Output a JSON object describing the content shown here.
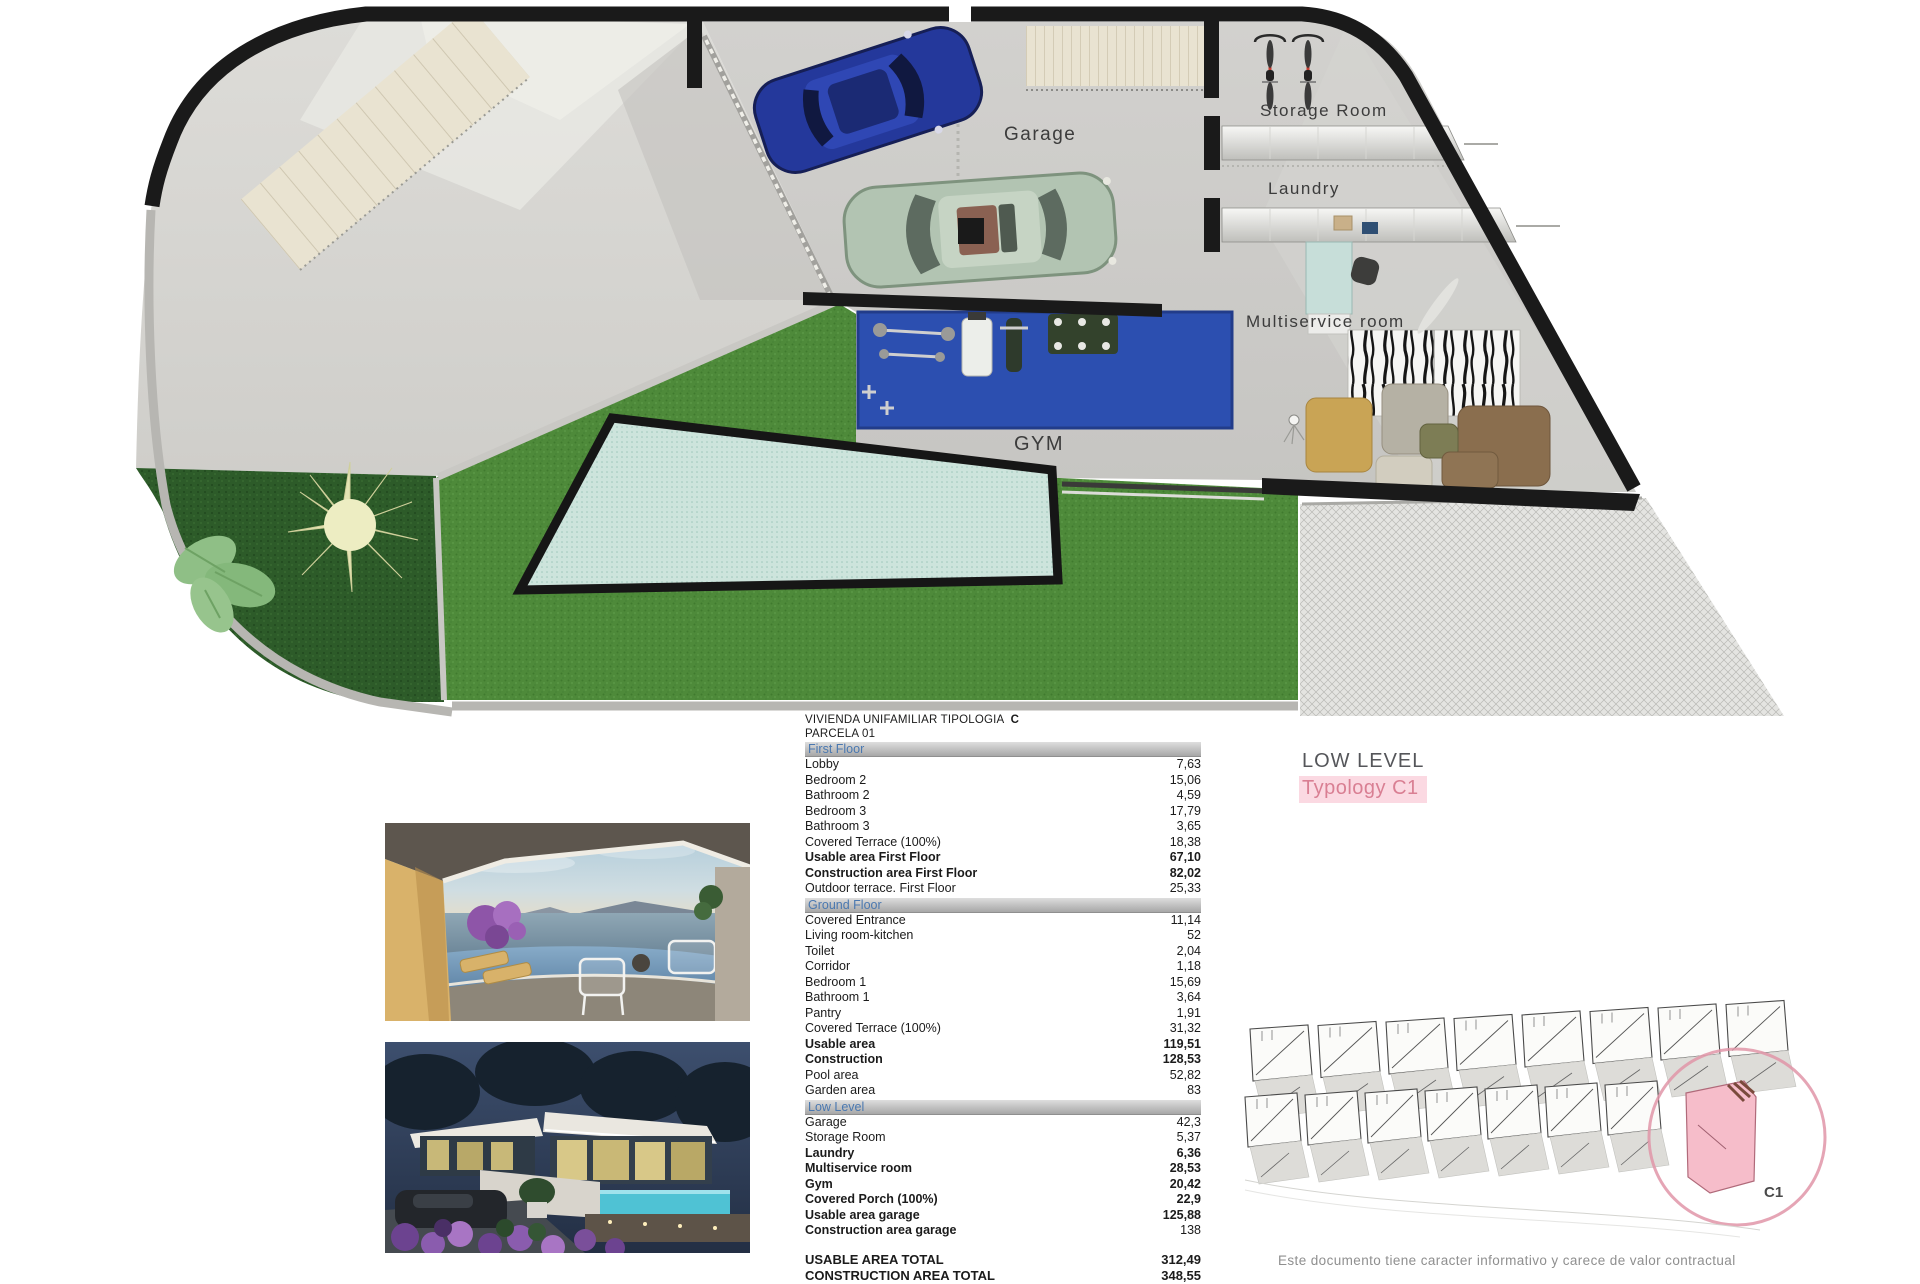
{
  "document": {
    "plan_labels": {
      "garage": "Garage",
      "storage_room": "Storage Room",
      "laundry": "Laundry",
      "multiservice_room": "Multiservice room",
      "gym": "GYM"
    },
    "level": {
      "title": "LOW LEVEL",
      "typology": "Typology C1"
    },
    "site_plan": {
      "unit_label": "C1"
    },
    "disclaimer": "Este documento tiene caracter informativo y carece de valor contractual"
  },
  "table": {
    "title": "VIVIENDA UNIFAMILIAR TIPOLOGIA",
    "title_type": "C",
    "subtitle": "PARCELA  01",
    "sections": [
      {
        "name": "First Floor",
        "rows": [
          {
            "label": "Lobby",
            "value": "7,63"
          },
          {
            "label": "Bedroom 2",
            "value": "15,06"
          },
          {
            "label": "Bathroom 2",
            "value": "4,59"
          },
          {
            "label": "Bedroom 3",
            "value": "17,79"
          },
          {
            "label": "Bathroom 3",
            "value": "3,65"
          },
          {
            "label": "Covered Terrace (100%)",
            "value": "18,38"
          },
          {
            "label": "Usable area First Floor",
            "value": "67,10",
            "bold": true
          },
          {
            "label": "Construction area First Floor",
            "value": "82,02",
            "bold": true
          },
          {
            "label": "Outdoor terrace.  First Floor",
            "value": "25,33"
          }
        ]
      },
      {
        "name": "Ground Floor",
        "rows": [
          {
            "label": "Covered Entrance",
            "value": "11,14"
          },
          {
            "label": "Living room-kitchen",
            "value": "52"
          },
          {
            "label": "Toilet",
            "value": "2,04"
          },
          {
            "label": "Corridor",
            "value": "1,18"
          },
          {
            "label": "Bedroom 1",
            "value": "15,69"
          },
          {
            "label": "Bathroom 1",
            "value": "3,64"
          },
          {
            "label": "Pantry",
            "value": "1,91"
          },
          {
            "label": "Covered Terrace (100%)",
            "value": "31,32"
          },
          {
            "label": "Usable area",
            "value": "119,51",
            "bold": true
          },
          {
            "label": "Construction",
            "value": "128,53",
            "bold": true
          },
          {
            "label": "Pool area",
            "value": "52,82"
          },
          {
            "label": "Garden area",
            "value": "83"
          }
        ]
      },
      {
        "name": "Low Level",
        "rows": [
          {
            "label": "Garage",
            "value": "42,3"
          },
          {
            "label": "Storage Room",
            "value": "5,37"
          },
          {
            "label": "Laundry",
            "value": "6,36",
            "bold": true
          },
          {
            "label": "Multiservice room",
            "value": "28,53",
            "bold": true
          },
          {
            "label": "Gym",
            "value": "20,42",
            "bold": true
          },
          {
            "label": "Covered Porch (100%)",
            "value": "22,9",
            "bold": true
          },
          {
            "label": "Usable area garage",
            "value": "125,88",
            "bold": true
          },
          {
            "label": "Construction area garage",
            "value": "138",
            "bold": true,
            "value_bold": false
          }
        ]
      }
    ],
    "totals": [
      {
        "label": "USABLE AREA TOTAL",
        "value": "312,49"
      },
      {
        "label": "CONSTRUCTION AREA TOTAL",
        "value": "348,55"
      }
    ]
  },
  "colors": {
    "wall_black": "#1a1a1a",
    "grass": "#4e8a3a",
    "garden_dark": "#2d5b29",
    "pool": "#cde4dc",
    "gym_mat": "#2c4fb0",
    "section_header_text": "#4a78b0",
    "typology_pink": "#d97f93",
    "typology_bg": "#fbd9e2",
    "highlight_pink": "#f6bdca"
  }
}
